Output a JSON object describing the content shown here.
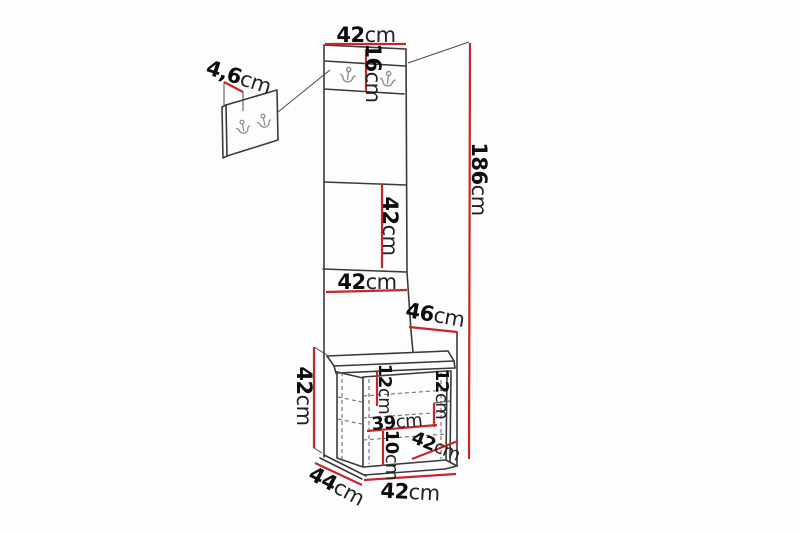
{
  "diagram": {
    "type": "furniture-dimension-drawing",
    "subject": "hallway panel with hook rail, wall hook panel detail and seat bench",
    "colors": {
      "dimension_line": "#c3272b",
      "outline": "#3b3b3b",
      "hook_metal": "#8f8f8f",
      "background": "#fdfdfd"
    },
    "dims": {
      "panel_width_top": {
        "value": "42",
        "unit": "cm"
      },
      "hook_rail_height": {
        "value": "16",
        "unit": "cm"
      },
      "hook_panel_thickness": {
        "value": "4,6",
        "unit": "cm"
      },
      "total_height": {
        "value": "186",
        "unit": "cm"
      },
      "middle_panel_height": {
        "value": "42",
        "unit": "cm"
      },
      "lower_panel_width": {
        "value": "42",
        "unit": "cm"
      },
      "side_depth": {
        "value": "46",
        "unit": "cm"
      },
      "bench_height": {
        "value": "42",
        "unit": "cm"
      },
      "inner_height_left": {
        "value": "12",
        "unit": "cm"
      },
      "inner_height_right": {
        "value": "12",
        "unit": "cm"
      },
      "inner_width": {
        "value": "39",
        "unit": "cm"
      },
      "plinth_height": {
        "value": "10",
        "unit": "cm"
      },
      "seat_depth": {
        "value": "42",
        "unit": "cm"
      },
      "bench_depth": {
        "value": "44",
        "unit": "cm"
      },
      "bench_width": {
        "value": "42",
        "unit": "cm"
      }
    }
  }
}
